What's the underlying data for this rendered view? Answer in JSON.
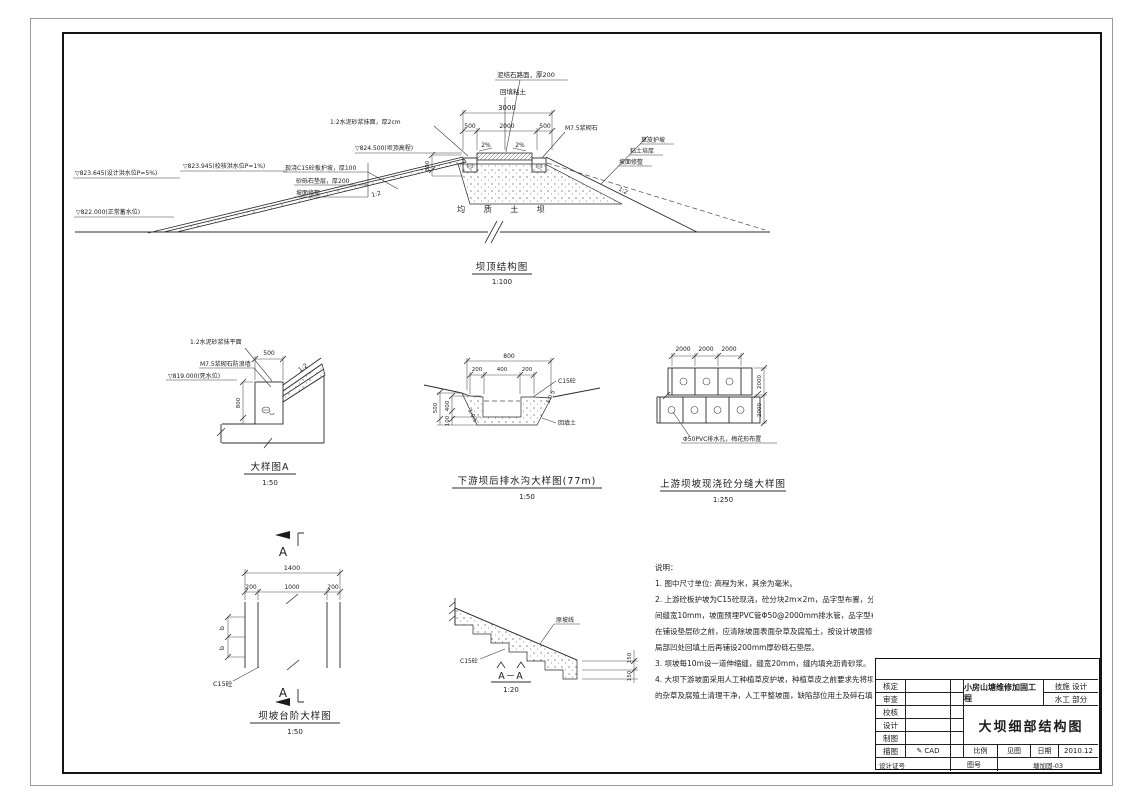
{
  "crest_section": {
    "title": "坝顶结构图",
    "scale": "1:100",
    "labels": {
      "road": "泥结石路面，厚200",
      "fill": "回填粘土",
      "mortar": "1:2水泥砂浆抹面，厚2cm",
      "masonry": "M7.5浆砌石",
      "crest_level": "▽824.500(坝顶高程)",
      "slope_pct_left": "2%",
      "slope_pct_right": "2%",
      "check_flood": "▽823.945(校核洪水位P=1%)",
      "design_flood": "▽823.645(设计洪水位P=5%)",
      "normal_level": "▽822.000(正常蓄水位)",
      "slab": "现浇C15砼板护坡，厚100",
      "cushion": "砂砾石垫层，厚200",
      "trim_left": "坡面修整",
      "grass": "草皮护坡",
      "clay": "粘土培厚",
      "trim_right": "坡面修整",
      "body": "均 质 土 坝",
      "slope_up": "1:2",
      "slope_down": "1:2"
    },
    "dims": {
      "total": "3000",
      "left": "500",
      "mid": "2000",
      "right": "500",
      "wall_h": "800"
    }
  },
  "detail_a": {
    "title": "大样图A",
    "scale": "1:50",
    "labels": {
      "mortar_top": "1:2水泥砂浆抹平面",
      "wall": "M7.5浆砌石防浪墙",
      "dead_level": "▽819.000(死水位)",
      "slope": "1:2"
    },
    "dims": {
      "width": "500",
      "height": "800"
    }
  },
  "drain_detail": {
    "title": "下游坝后排水沟大样图(77m)",
    "scale": "1:50",
    "labels": {
      "concrete": "C15砼",
      "backfill": "回填土",
      "slope_left": "1:0.5",
      "slope_right": "1:0.5"
    },
    "dims": {
      "total": "800",
      "left": "200",
      "mid": "400",
      "right": "200",
      "depth": "500",
      "inner": "400",
      "base": "100"
    }
  },
  "slab_joint_detail": {
    "title": "上游坝坡现浇砼分缝大样图",
    "scale": "1:250",
    "labels": {
      "pipe": "Φ50PVC排水孔，梅花形布置"
    },
    "dims": {
      "d1": "2000",
      "d2": "2000",
      "d3": "2000",
      "r1": "2000",
      "r2": "2000"
    }
  },
  "steps_plan": {
    "title": "坝坡台阶大样图",
    "scale": "1:50",
    "section_mark": "A",
    "labels": {
      "concrete": "C15砼"
    },
    "dims": {
      "total": "1400",
      "left": "200",
      "mid": "1000",
      "right": "200",
      "b1": "b",
      "b2": "b"
    }
  },
  "steps_section": {
    "title": "A－A",
    "scale": "1:20",
    "labels": {
      "orig_slope": "原坡线",
      "concrete": "C15砼"
    },
    "dims": {
      "r1": "150",
      "r2": "150"
    }
  },
  "notes": {
    "heading": "说明：",
    "lines": [
      "1. 图中尺寸单位: 高程为米，其余为毫米。",
      "2. 上游砼板护坡为C15砼现浇，砼分块2m×2m，品字型布置，分块",
      "间缝宽10mm，坡面预埋PVC管Φ50@2000mm排水管，品字型布置，",
      "在铺设垫层砂之前，应清除坡面表面杂草及腐殖土，按设计坡面修整，",
      "局部凹处回填土后再铺设200mm厚砂砾石垫层。",
      "3. 坝坡每10m设一道伸缩缝，缝宽20mm，缝内填充沥青砂浆。",
      "4. 大坝下游坡面采用人工种植草皮护坡，种植草皮之前要求先将坝面",
      "的杂草及腐殖土清理干净，人工平整坡面，缺陷部位用土及碎石填补。"
    ]
  },
  "titleblock": {
    "rows": [
      "核定",
      "审查",
      "校核",
      "设计",
      "制图",
      "描图"
    ],
    "cert_label": "设计证号",
    "cad_icon": "✎",
    "cad": "CAD",
    "project": "小房山塘维修加固工程",
    "stage": "技施 设计",
    "section": "水工 部分",
    "drawing_title": "大坝细部结构图",
    "scale_label": "比例",
    "scale_value": "见图",
    "date_label": "日期",
    "date_value": "2010.12",
    "no_label": "图号",
    "no_value": "塘加固-03"
  }
}
